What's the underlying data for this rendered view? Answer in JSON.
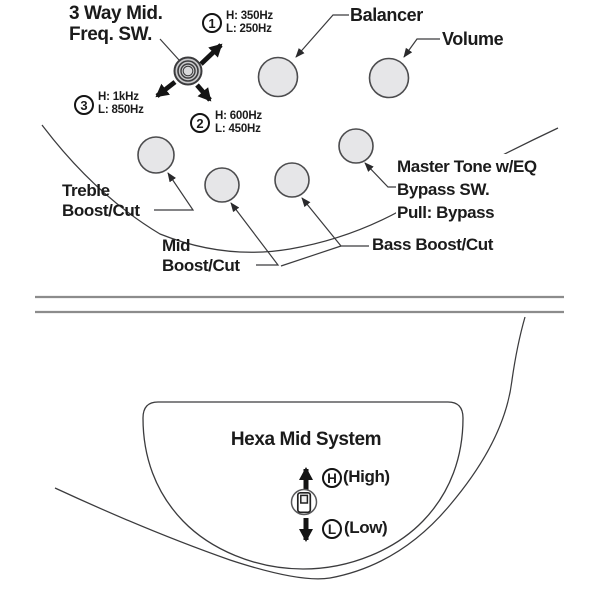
{
  "diagram": {
    "title_switch": {
      "line1": "3 Way Mid.",
      "line2": "Freq. SW."
    },
    "freq_positions": [
      {
        "num": "1",
        "high": "H: 350Hz",
        "low": "L: 250Hz"
      },
      {
        "num": "2",
        "high": "H: 600Hz",
        "low": "L: 450Hz"
      },
      {
        "num": "3",
        "high": "H: 1kHz",
        "low": "L: 850Hz"
      }
    ],
    "labels": {
      "balancer": "Balancer",
      "volume": "Volume",
      "treble1": "Treble",
      "treble2": "Boost/Cut",
      "mid1": "Mid",
      "mid2": "Boost/Cut",
      "bass": "Bass Boost/Cut",
      "master1": "Master Tone w/EQ",
      "master2": "Bypass SW.",
      "master3": "Pull: Bypass"
    },
    "hexa": {
      "title": "Hexa Mid System",
      "high_letter": "H",
      "high": "(High)",
      "low_letter": "L",
      "low": "(Low)"
    },
    "colors": {
      "knob_fill": "#e6e6e8",
      "knob_stroke": "#4c4c4e",
      "line": "#3b3b3d",
      "text": "#1b1b1b",
      "divider": "#8c8c8c"
    }
  }
}
